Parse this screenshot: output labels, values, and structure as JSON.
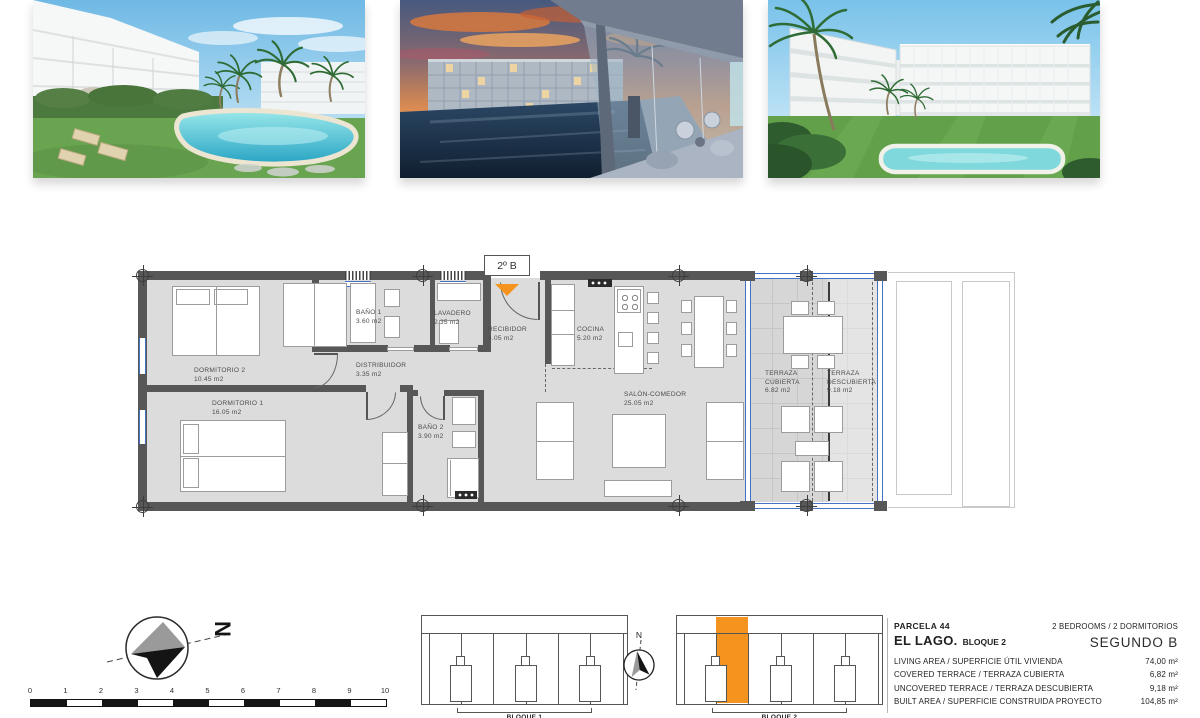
{
  "plan": {
    "entrance_label": "2º B",
    "rooms": [
      {
        "name": "DORMITORIO 2",
        "area": "10.45 m2"
      },
      {
        "name": "DORMITORIO 1",
        "area": "16.05 m2"
      },
      {
        "name": "BAÑO 1",
        "area": "3.60 m2"
      },
      {
        "name": "LAVADERO",
        "area": "2.35 m2"
      },
      {
        "name": "RECIBIDOR",
        "area": "4.05 m2"
      },
      {
        "name": "DISTRIBUIDOR",
        "area": "3.35 m2"
      },
      {
        "name": "BAÑO 2",
        "area": "3.90 m2"
      },
      {
        "name": "COCINA",
        "area": "5.20 m2"
      },
      {
        "name": "SALÓN-COMEDOR",
        "area": "25.05 m2"
      },
      {
        "name": "TERRAZA CUBIERTA",
        "area": "6.82 m2"
      },
      {
        "name": "TERRAZA DESCUBIERTA",
        "area": "9.18 m2"
      }
    ]
  },
  "compass": {
    "north": "N",
    "site_north": "N"
  },
  "scale_bar": {
    "ticks": [
      "0",
      "1",
      "2",
      "3",
      "4",
      "5",
      "6",
      "7",
      "8",
      "9",
      "10"
    ]
  },
  "site": {
    "block1_label": "BLOQUE 1",
    "block2_label": "BLOQUE 2"
  },
  "info": {
    "parcela": "PARCELA 44",
    "project": "EL LAGO.",
    "block": "BLOQUE 2",
    "bedrooms": "2 BEDROOMS / 2 DORMITORIOS",
    "floor_unit": "SEGUNDO B",
    "rows": [
      {
        "label": "LIVING AREA / SUPERFICIE ÚTIL VIVIENDA",
        "value": "74,00 m²"
      },
      {
        "label": "COVERED TERRACE / TERRAZA CUBIERTA",
        "value": "6,82 m²"
      },
      {
        "label": "UNCOVERED TERRACE / TERRAZA DESCUBIERTA",
        "value": "9,18 m²"
      },
      {
        "label": "BUILT AREA / SUPERFICIE CONSTRUIDA PROYECTO",
        "value": "104,85 m²"
      }
    ]
  },
  "colors": {
    "accent_orange": "#F4931E",
    "glass_blue": "#4472C4",
    "wall_gray": "#575757",
    "floor_gray": "#DCDCDC"
  }
}
